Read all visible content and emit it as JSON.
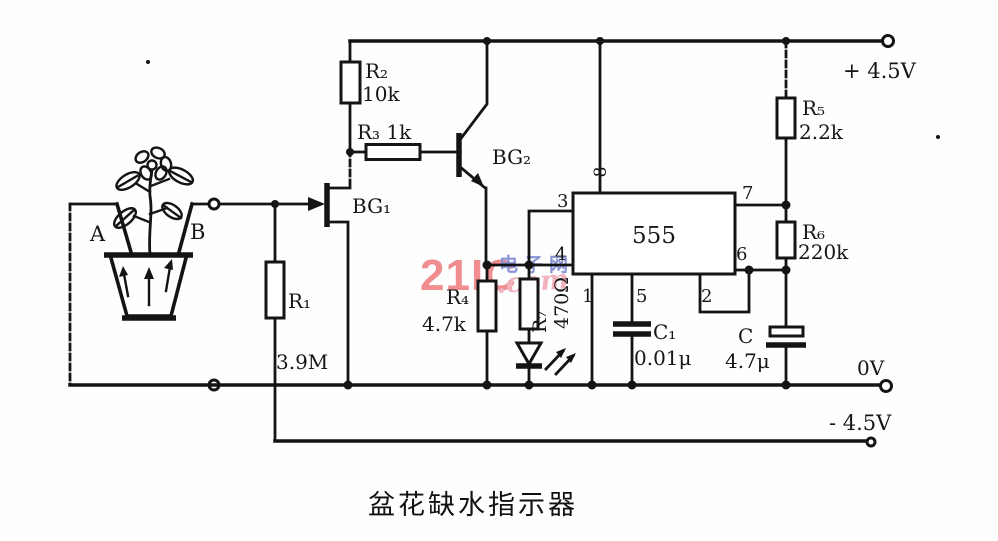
{
  "caption": "盆花缺水指示器",
  "rails": {
    "positive_label": "+ 4.5V",
    "zero_label": "0V",
    "negative_label": "- 4.5V"
  },
  "electrodes": {
    "a": "A",
    "b": "B"
  },
  "transistors": {
    "bg1": "BG₁",
    "bg2": "BG₂"
  },
  "resistors": {
    "r1": {
      "name": "R₁",
      "value": "3.9M"
    },
    "r2": {
      "name": "R₂",
      "value": "10k"
    },
    "r3": {
      "name": "R₃ 1k"
    },
    "r4": {
      "name": "R₄",
      "value": "4.7k"
    },
    "r5": {
      "name": "R₅",
      "value": "2.2k"
    },
    "r6": {
      "name": "R₆",
      "value": "220k"
    },
    "r7": {
      "name": "R₇",
      "value": "470Ω"
    }
  },
  "capacitors": {
    "c1": {
      "name": "C₁",
      "value": "0.01μ"
    },
    "c": {
      "name": "C",
      "value": "4.7μ"
    }
  },
  "ic555": {
    "label": "555",
    "pins": {
      "p1": "1",
      "p2": "2",
      "p3": "3",
      "p4": "4",
      "p5": "5",
      "p6": "6",
      "p7": "7",
      "p8": "8"
    }
  },
  "watermark": {
    "brand": "21IC",
    "site_cn": "电子网",
    "dotcom": ".com",
    "colors": {
      "brand": "#ee8183",
      "cn": "#7d87d2",
      "dotcom": "#f0a9b6"
    }
  }
}
